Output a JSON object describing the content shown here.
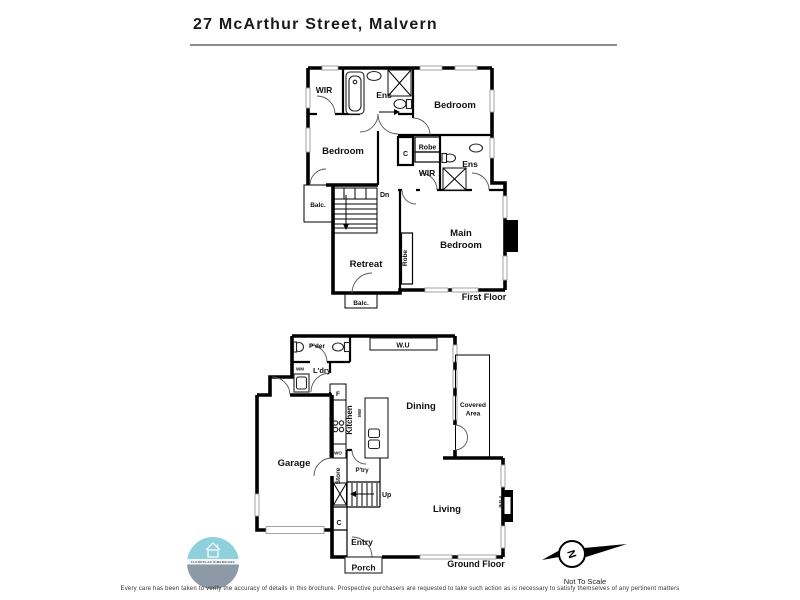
{
  "title": "27 McArthur Street, Malvern",
  "first_floor": {
    "floor_label": "First Floor",
    "rooms": {
      "wir_top": "WIR",
      "ens_top": "Ens",
      "bedroom_right": "Bedroom",
      "bedroom_left": "Bedroom",
      "closet": "C",
      "robe_small": "Robe",
      "wir_mid": "WIR",
      "ens_mid": "Ens",
      "main_line1": "Main",
      "main_line2": "Bedroom",
      "retreat": "Retreat",
      "robe_tall": "Robe",
      "balc_left": "Balc.",
      "balc_bottom": "Balc.",
      "stairs_dn": "Dn"
    }
  },
  "ground_floor": {
    "floor_label": "Ground Floor",
    "rooms": {
      "powder": "P'der",
      "wall_unit": "W.U",
      "washing_machine": "WM",
      "laundry": "L'dry",
      "fridge": "F",
      "kitchen": "Kitchen",
      "microwave": "MW",
      "dining": "Dining",
      "covered_line1": "Covered",
      "covered_line2": "Area",
      "garage": "Garage",
      "wall_oven": "WO",
      "pantry": "P'try",
      "store": "Store",
      "stairs_up": "Up",
      "living": "Living",
      "fire": "Fire",
      "closet": "C",
      "entry": "Entry",
      "porch": "Porch"
    }
  },
  "footer": {
    "disclaimer": "Every care has been taken to verify the accuracy of details in this brochure. Prospective purchasers are requested to take such action as is necessary to satisfy themselves of any pertinent matters",
    "not_to_scale": "Not To Scale",
    "compass_letter": "N",
    "logo_text": "FLOORPLAN DIMENSIONS"
  },
  "colors": {
    "logo_top": "#8FD0DD",
    "logo_bottom": "#8D99A6",
    "wall": "#000000",
    "rule": "#8C8C8C"
  }
}
